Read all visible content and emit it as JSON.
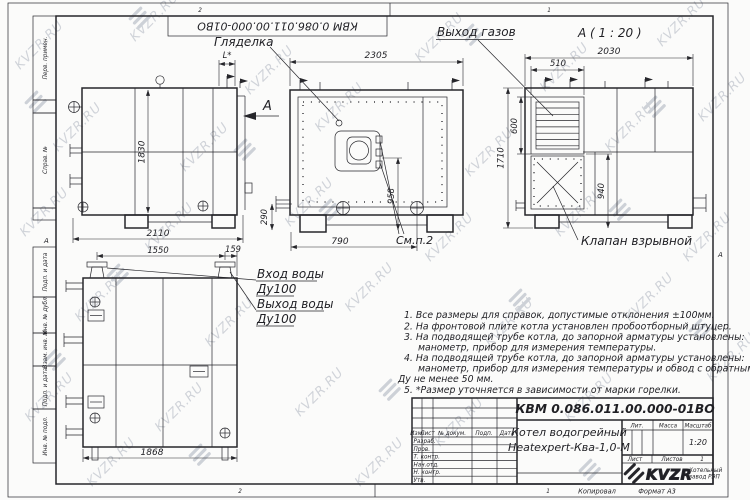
{
  "watermark": {
    "text": "KVZR.RU"
  },
  "sheet": {
    "zone_top_left": "2",
    "zone_top_right": "1",
    "zone_bottom_left": "2",
    "zone_bottom_right": "1",
    "side_marker_left": "А",
    "side_marker_right": "А",
    "copied": "Копировал",
    "format": "Формат А3",
    "doc_number_rotated": "КВМ 0.086.011.00.000-01ВО",
    "margin_labels": [
      "Перв. примен.",
      "Справ. №",
      "Подп. и дата",
      "Инв. № дубл.",
      "Взам. инв. №",
      "Подп. и дата",
      "Инв. № подл."
    ]
  },
  "views": {
    "side": {
      "dim_width": "2110",
      "dim_height": "1830",
      "dim_l": "L*",
      "arrow_label": "А"
    },
    "front": {
      "dim_width": "2305",
      "dim_burner": "790",
      "dim_burner_h": "958",
      "dim_pipe": "290",
      "label_sight": "Гляделка",
      "label_see": "См.п.2"
    },
    "section": {
      "title": "А ( 1 : 20 )",
      "dim_width": "2030",
      "dim_flue": "510",
      "dim_flue_h": "600",
      "dim_height": "1710",
      "dim_valve": "940",
      "label_gas": "Выход газов",
      "label_valve": "Клапан взрывной"
    },
    "plan": {
      "dim_flanges": "1550",
      "dim_edge": "159",
      "dim_length": "1868",
      "label_in": "Вход воды",
      "label_in_dn": "Ду100",
      "label_out": "Выход воды",
      "label_out_dn": "Ду100"
    }
  },
  "notes": {
    "lines": [
      "1. Все размеры для справок, допустимые отклонения ±100мм.",
      "2. На фронтовой плите котла установлен пробоотборный штуцер.",
      "3. На подводящей трубе котла, до запорной арматуры установлены:",
      "манометр, прибор для измерения температуры.",
      "4. На подводящей трубе котла, до запорной арматуры установлены:",
      "манометр, прибор для измерения температуры и обвод с обратным клапаном",
      "Ду не менее 50 мм.",
      "5. *Размер уточняется в зависимости от марки горелки."
    ]
  },
  "title_block": {
    "doc_number": "КВМ 0.086.011.00.000-01ВО",
    "product_line1": "Котел водогрейный",
    "product_line2": "Heatexpert-Ква-1,0-М",
    "scale_value": "1:20",
    "sheets_value": "1",
    "col_izm": "Изм.",
    "col_list": "Лист",
    "col_doc": "№ докум.",
    "col_sign": "Подп.",
    "col_date": "Дата",
    "col_lit": "Лит.",
    "col_mass": "Масса",
    "col_scale": "Масштаб",
    "sheet_label": "Лист",
    "sheets_label": "Листов",
    "row_labels": [
      "Разраб.",
      "Пров.",
      "Т. контр.",
      "Нач.отд.",
      "Н. контр.",
      "Утв."
    ],
    "logo_text": "KVZR",
    "logo_sub_line1": "Котельный",
    "logo_sub_line2": "завод РЭП"
  },
  "colors": {
    "line": "#26262b",
    "watermark": "#c6cad1",
    "paper": "#fbfbfa"
  }
}
